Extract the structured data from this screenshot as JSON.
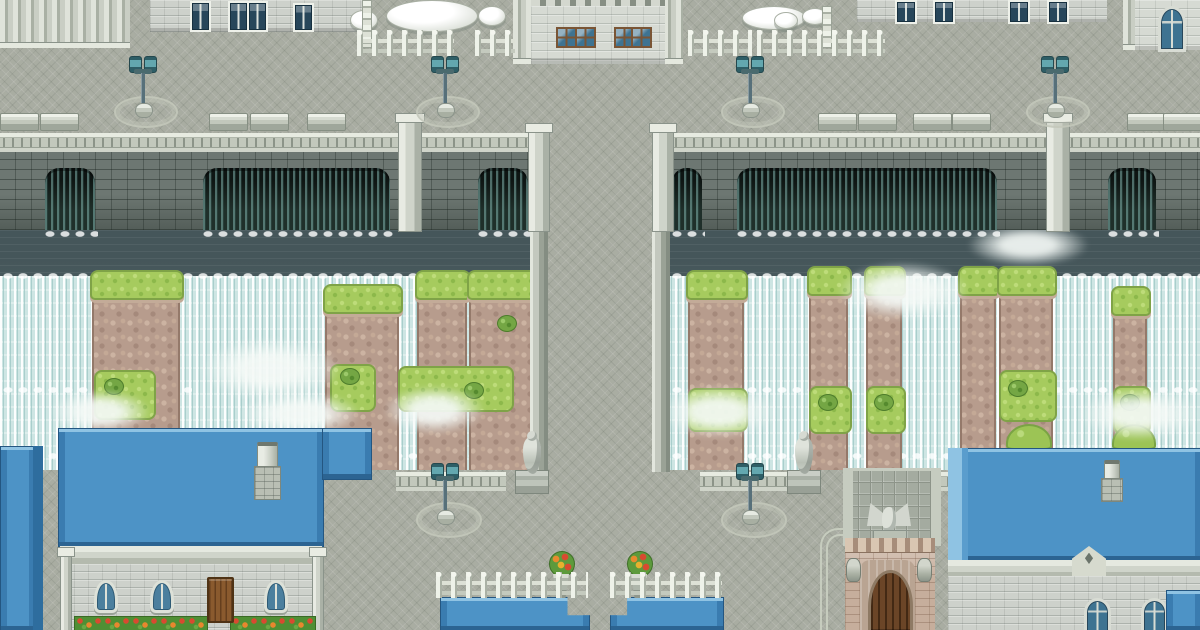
{
  "scene": {
    "type": "rpg-town-map",
    "description": "Top-down pixel-art RPG town: stone plaza, dam bridge with arches, cascading waterfalls over rocky cliffs, blue-roofed stone buildings, gate house, lamps, benches, fences and statues. No text visible.",
    "width": 1200,
    "height": 630
  },
  "palette": {
    "pavement": "#a9ada2",
    "stone_light": "#cdd1cb",
    "dam_wall": "#6d7772",
    "water_dark": "#546568",
    "falls": "#cde5e3",
    "arch_dark": "#1f2f2a",
    "rock": "#b79c8d",
    "grass": "#a6cb5e",
    "roof_blue": "#4d93c6",
    "window_blue": "#3e7391",
    "frame_brown": "#7a5535",
    "door_brown": "#8a5a2e",
    "lamp_teal": "#63a7af",
    "fence_white": "#eef2e9",
    "gate_beige": "#c6ae9c",
    "flower_red": "#d84a30",
    "flower_orange": "#e8872e"
  },
  "sprites": {
    "lamps": [
      [
        128,
        56
      ],
      [
        430,
        56
      ],
      [
        735,
        56
      ],
      [
        1040,
        56
      ],
      [
        430,
        463
      ],
      [
        735,
        463
      ]
    ],
    "medallions": [
      [
        114,
        96,
        60,
        28
      ],
      [
        416,
        96,
        60,
        28
      ],
      [
        721,
        96,
        60,
        28
      ],
      [
        1026,
        96,
        60,
        28
      ],
      [
        416,
        502,
        62,
        32
      ],
      [
        721,
        502,
        62,
        32
      ]
    ],
    "benches": [
      [
        0,
        113
      ],
      [
        40,
        113
      ],
      [
        209,
        113
      ],
      [
        250,
        113
      ],
      [
        307,
        113
      ],
      [
        818,
        113
      ],
      [
        858,
        113
      ],
      [
        913,
        113
      ],
      [
        952,
        113
      ],
      [
        1127,
        113
      ],
      [
        1163,
        113
      ]
    ],
    "fences_h": [
      [
        357,
        30,
        97
      ],
      [
        475,
        30,
        40
      ],
      [
        688,
        30,
        64
      ],
      [
        757,
        30,
        128
      ],
      [
        436,
        572,
        152
      ],
      [
        610,
        572,
        112
      ]
    ],
    "fences_v": [
      [
        362,
        0,
        46
      ],
      [
        822,
        6,
        40
      ]
    ],
    "tables": [
      [
        386,
        0,
        90,
        30
      ],
      [
        350,
        10,
        26,
        18
      ],
      [
        478,
        6,
        26,
        18
      ],
      [
        742,
        6,
        62,
        22
      ],
      [
        774,
        12,
        22,
        15
      ],
      [
        802,
        8,
        24,
        15
      ]
    ],
    "arches": [
      [
        45,
        168,
        50
      ],
      [
        203,
        168,
        187
      ],
      [
        478,
        168,
        50
      ],
      [
        672,
        168,
        30
      ],
      [
        737,
        168,
        260
      ],
      [
        1108,
        168,
        48
      ]
    ],
    "pillars": [
      [
        398,
        114,
        22,
        116
      ],
      [
        1046,
        114,
        22,
        116
      ],
      [
        528,
        124,
        20,
        106
      ],
      [
        652,
        124,
        20,
        106
      ]
    ],
    "balustrades": [
      [
        0,
        133,
        528
      ],
      [
        672,
        133,
        528
      ],
      [
        396,
        472,
        110
      ],
      [
        700,
        472,
        100
      ],
      [
        935,
        472,
        265
      ]
    ],
    "rock_columns": [
      [
        92,
        270,
        88
      ],
      [
        325,
        284,
        74
      ],
      [
        417,
        270,
        50
      ],
      [
        469,
        270,
        66
      ],
      [
        688,
        270,
        56
      ],
      [
        809,
        266,
        39
      ],
      [
        866,
        266,
        36
      ],
      [
        960,
        266,
        36
      ],
      [
        999,
        266,
        54
      ],
      [
        1113,
        286,
        34
      ]
    ],
    "grass_feet": [
      [
        94,
        370,
        58,
        46
      ],
      [
        330,
        364,
        42,
        44
      ],
      [
        398,
        366,
        112,
        42
      ],
      [
        688,
        388,
        56,
        40
      ],
      [
        809,
        386,
        39,
        44
      ],
      [
        866,
        386,
        36,
        44
      ],
      [
        999,
        370,
        54,
        48
      ],
      [
        1113,
        386,
        34,
        44
      ]
    ],
    "bushes": [
      [
        104,
        378
      ],
      [
        340,
        368
      ],
      [
        464,
        382
      ],
      [
        818,
        394
      ],
      [
        874,
        394
      ],
      [
        1008,
        380
      ],
      [
        1120,
        394
      ],
      [
        497,
        315
      ]
    ],
    "grass_mounds": [
      [
        1006,
        424,
        42,
        22
      ],
      [
        1112,
        424,
        40,
        22
      ]
    ],
    "mist": [
      [
        200,
        338,
        140,
        62
      ],
      [
        838,
        262,
        130,
        58
      ],
      [
        384,
        386,
        100,
        48
      ],
      [
        660,
        386,
        116,
        52
      ],
      [
        50,
        390,
        100,
        44
      ],
      [
        968,
        224,
        120,
        42
      ],
      [
        1078,
        388,
        122,
        52
      ],
      [
        240,
        392,
        120,
        44
      ]
    ],
    "foam_rows": [
      [
        42,
        228,
        56
      ],
      [
        200,
        228,
        193
      ],
      [
        475,
        228,
        56
      ],
      [
        669,
        228,
        36
      ],
      [
        734,
        228,
        266
      ],
      [
        1105,
        228,
        54
      ],
      [
        0,
        270,
        546
      ],
      [
        654,
        270,
        546
      ],
      [
        0,
        384,
        192
      ],
      [
        396,
        372,
        118
      ],
      [
        654,
        384,
        162
      ],
      [
        1050,
        384,
        150
      ],
      [
        0,
        450,
        546
      ],
      [
        654,
        450,
        546
      ]
    ],
    "statues": [
      [
        512,
        424
      ],
      [
        784,
        424
      ]
    ],
    "planters": [
      [
        549,
        551
      ],
      [
        627,
        551
      ]
    ],
    "chimneys": [
      [
        252,
        442,
        30,
        58
      ],
      [
        1100,
        460,
        24,
        42
      ]
    ],
    "urns": [
      [
        846,
        558,
        13,
        22
      ],
      [
        917,
        558,
        13,
        22
      ]
    ],
    "flowerboxes": [
      [
        74,
        616,
        132,
        14
      ],
      [
        230,
        616,
        84,
        14
      ]
    ],
    "windows_dk": [
      [
        190,
        1,
        17,
        27
      ],
      [
        228,
        1,
        17,
        27
      ],
      [
        247,
        1,
        17,
        27
      ],
      [
        293,
        3,
        17,
        25
      ],
      [
        895,
        0,
        18,
        20
      ],
      [
        933,
        0,
        18,
        20
      ],
      [
        1008,
        0,
        18,
        20
      ],
      [
        1047,
        0,
        18,
        20
      ]
    ],
    "windows_br": [
      [
        556,
        27,
        17,
        17
      ],
      [
        575,
        27,
        17,
        17
      ],
      [
        614,
        27,
        17,
        17
      ],
      [
        631,
        27,
        17,
        17
      ]
    ],
    "windows_arch": [
      [
        94,
        580,
        18,
        27
      ],
      [
        150,
        580,
        18,
        27
      ],
      [
        264,
        580,
        18,
        27
      ]
    ],
    "windows_goth": [
      [
        1158,
        6,
        22,
        40
      ],
      [
        1084,
        598,
        21,
        32
      ],
      [
        1141,
        598,
        21,
        32
      ]
    ],
    "doors": [
      [
        207,
        577,
        23,
        42
      ]
    ]
  }
}
